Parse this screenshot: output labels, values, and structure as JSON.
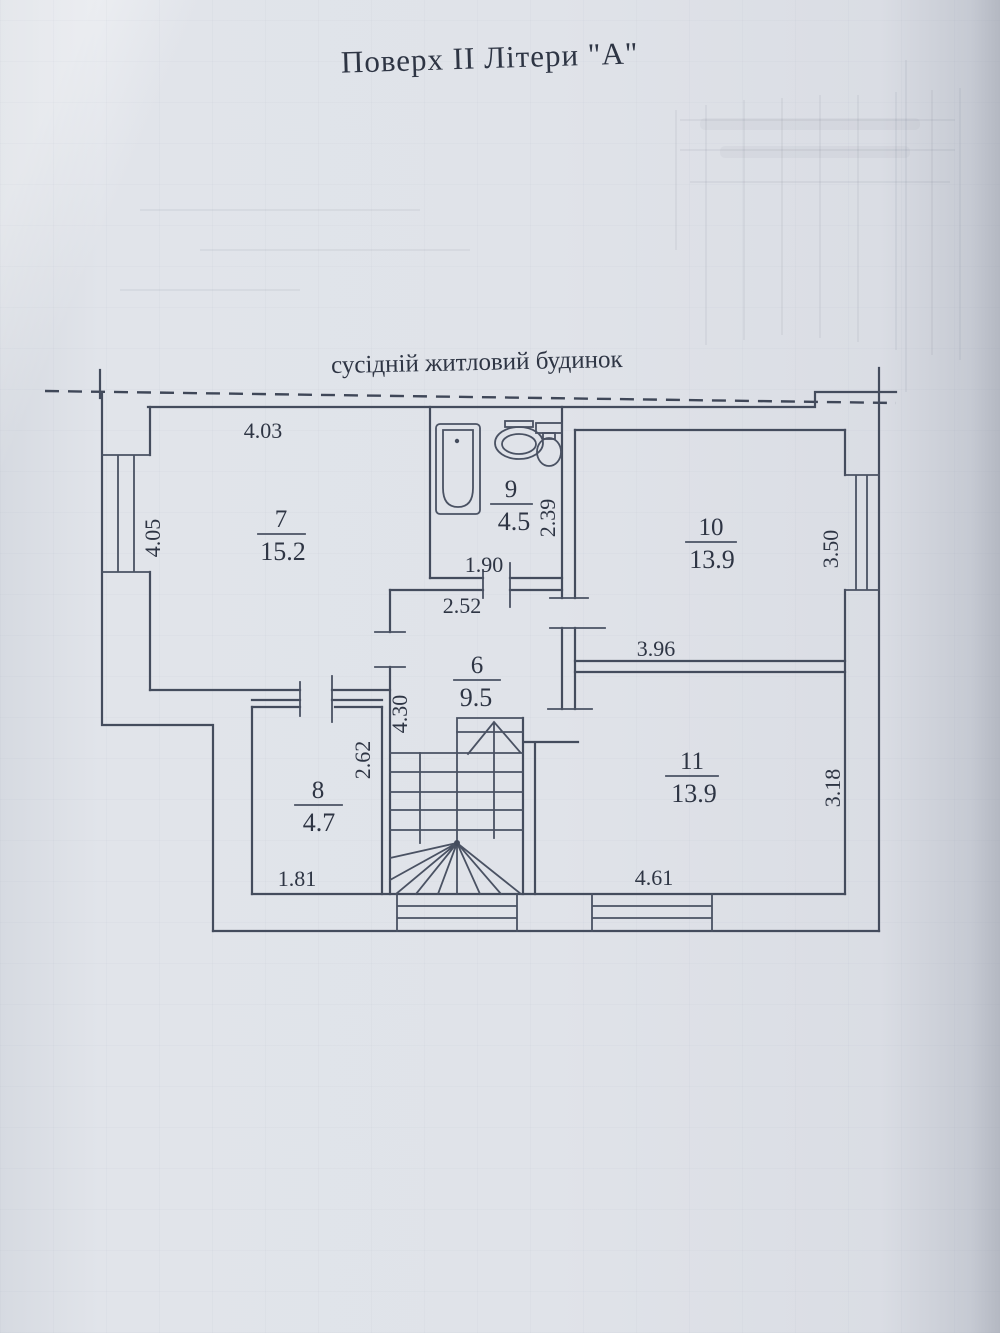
{
  "document": {
    "title": "Поверх II Літери \"А\"",
    "neighbor_label": "сусідній житловий будинок"
  },
  "colors": {
    "paper": "#dde1e7",
    "ink": "#434b5c"
  },
  "rooms": [
    {
      "number": "7",
      "area": "15.2"
    },
    {
      "number": "9",
      "area": "4.5"
    },
    {
      "number": "10",
      "area": "13.9"
    },
    {
      "number": "6",
      "area": "9.5"
    },
    {
      "number": "8",
      "area": "4.7"
    },
    {
      "number": "11",
      "area": "13.9"
    }
  ],
  "dims": {
    "room7_width": "4.03",
    "room7_height": "4.05",
    "bath_width": "1.90",
    "bath_height": "2.39",
    "hall_width": "2.52",
    "hall_height": "4.30",
    "room10_width": "3.96",
    "room10_height": "3.50",
    "room8_width": "1.81",
    "room8_height": "2.62",
    "room11_width": "4.61",
    "room11_height": "3.18"
  }
}
